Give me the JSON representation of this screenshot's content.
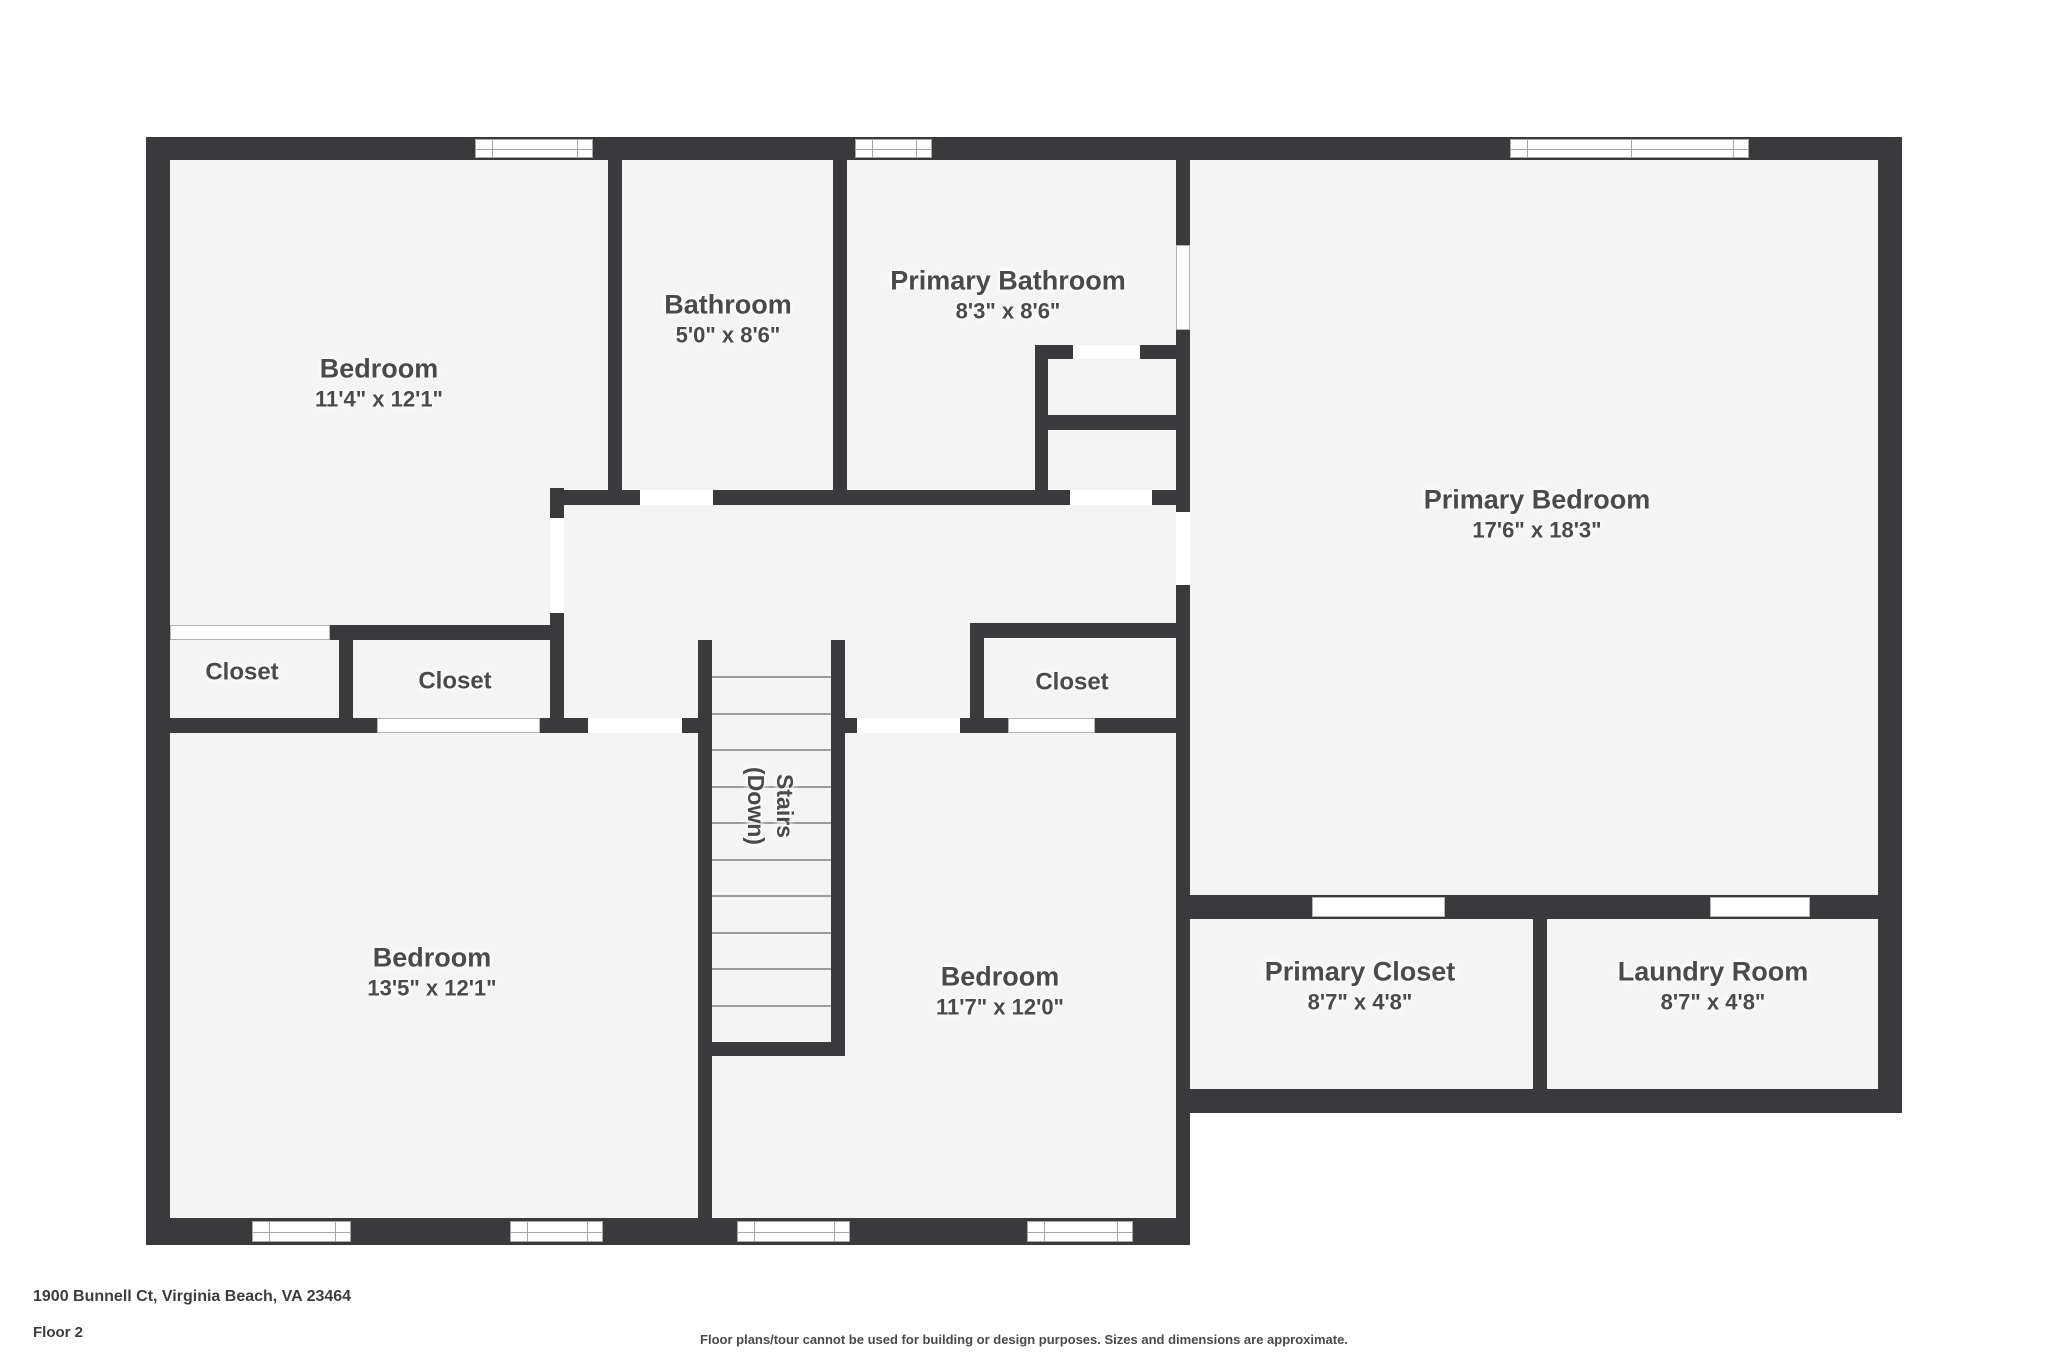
{
  "colors": {
    "wall": "#3a3a3c",
    "floor": "#f4f4f5",
    "text": "#4a4a4b"
  },
  "rooms": {
    "bedroom_tl": {
      "name": "Bedroom",
      "dims": "11'4\" x 12'1\""
    },
    "bathroom": {
      "name": "Bathroom",
      "dims": "5'0\" x 8'6\""
    },
    "primary_bathroom": {
      "name": "Primary Bathroom",
      "dims": "8'3\" x 8'6\""
    },
    "primary_bedroom": {
      "name": "Primary Bedroom",
      "dims": "17'6\" x 18'3\""
    },
    "closet_left": {
      "name": "Closet"
    },
    "closet_mid_left": {
      "name": "Closet"
    },
    "closet_hall": {
      "name": "Closet"
    },
    "stairs": {
      "name": "Stairs",
      "direction": "(Down)"
    },
    "bedroom_bl": {
      "name": "Bedroom",
      "dims": "13'5\" x 12'1\""
    },
    "bedroom_bm": {
      "name": "Bedroom",
      "dims": "11'7\" x 12'0\""
    },
    "primary_closet": {
      "name": "Primary Closet",
      "dims": "8'7\" x 4'8\""
    },
    "laundry": {
      "name": "Laundry Room",
      "dims": "8'7\" x 4'8\""
    }
  },
  "footer": {
    "address": "1900 Bunnell Ct, Virginia Beach, VA 23464",
    "floor": "Floor 2",
    "disclaimer": "Floor plans/tour cannot be used for building or design purposes. Sizes and dimensions are approximate."
  }
}
